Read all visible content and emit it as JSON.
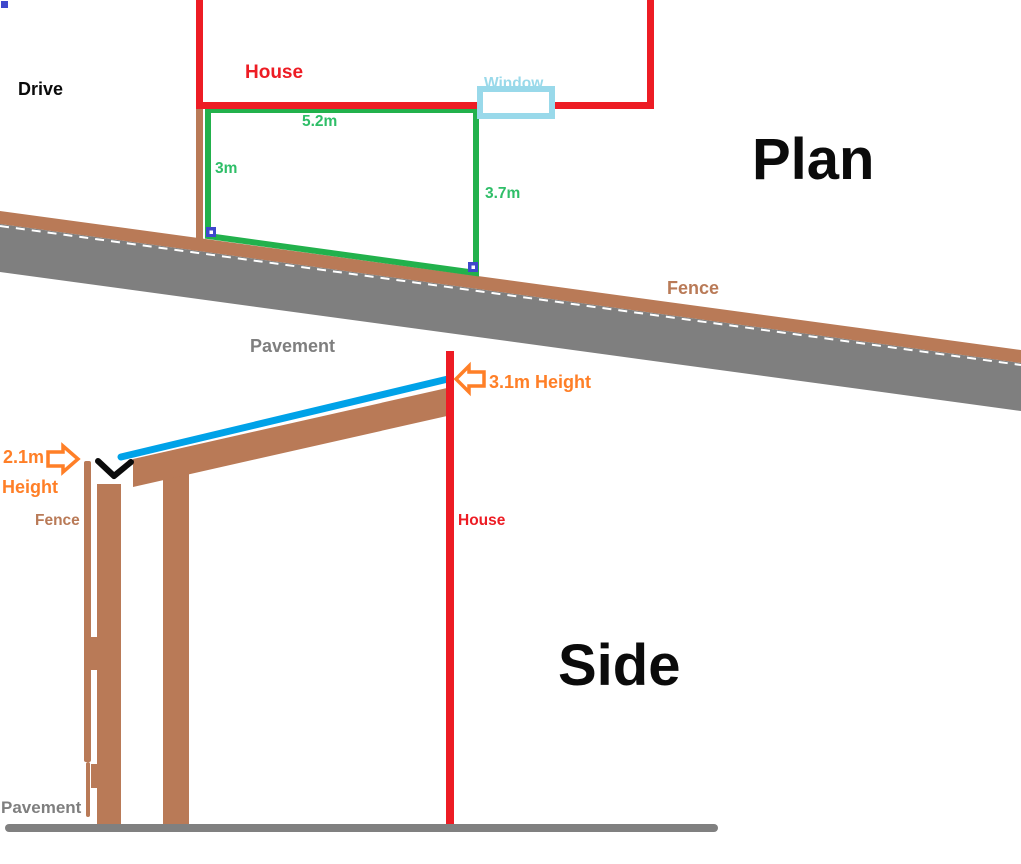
{
  "document": {
    "type": "hand-drawn-plan-sketch",
    "plan_view_title": "Plan",
    "side_view_title": "Side"
  },
  "plan": {
    "drive_label": "Drive",
    "house_label": "House",
    "window_label": "Window",
    "fence_label": "Fence",
    "pavement_label": "Pavement",
    "dimensions": {
      "top_width": "5.2m",
      "left_depth": "3m",
      "right_depth": "3.7m"
    }
  },
  "side": {
    "fence_label": "Fence",
    "house_label": "House",
    "pavement_label": "Pavement",
    "wall_height_label": "3.1m Height",
    "eave_height_value": "2.1m",
    "eave_height_word": "Height"
  },
  "icons": {
    "eave_height_arrow": "block-arrow-right",
    "wall_height_arrow": "block-arrow-left",
    "gutter_junction_mark": "check-v",
    "anchor_handles": "blue-square-handle",
    "corner_mark": "blue-square"
  },
  "colors": {
    "house_red": "#ED1C24",
    "boundary_green": "#22B14C",
    "dimension_green": "#2FBE68",
    "roof_blue": "#00A2E8",
    "wood_brown": "#B97A57",
    "pavement_gray": "#7F7F7F",
    "ground_gray": "#808080",
    "window_blue": "#99D9EA",
    "annotation_orange": "#FF7F27",
    "handle_blue": "#3F48CC",
    "mark_black": "#0b0b0b",
    "dash_white": "#FFFFFF"
  }
}
